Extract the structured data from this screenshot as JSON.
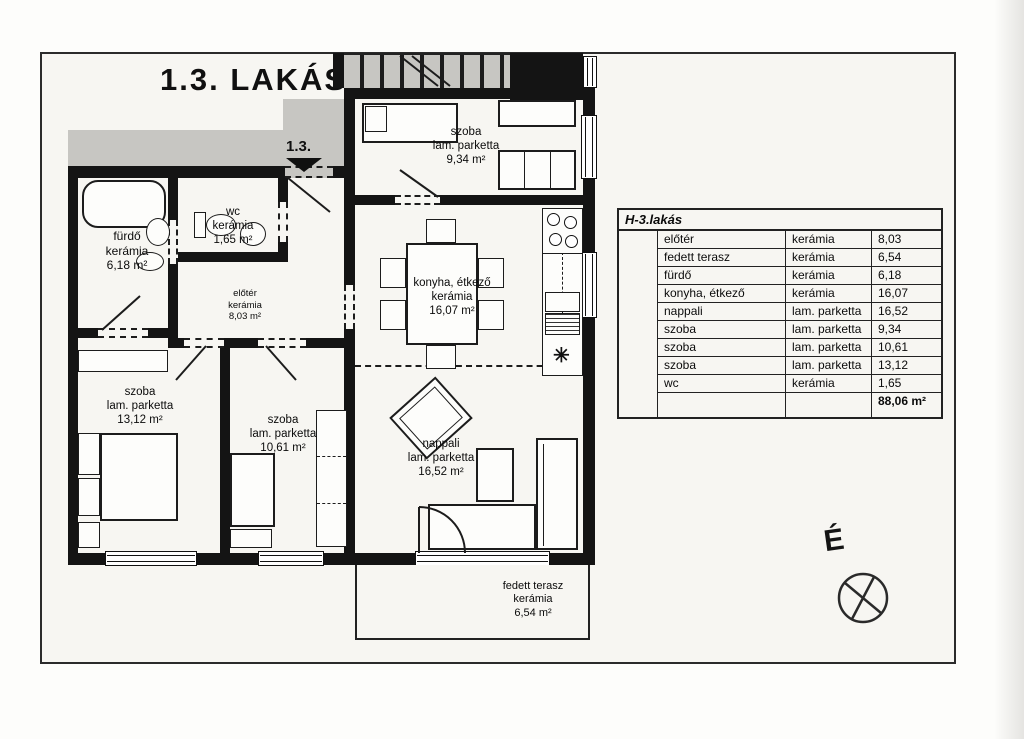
{
  "page": {
    "title": "1.3. LAKÁS",
    "entry_label": "1.3.",
    "compass_label": "É"
  },
  "plan": {
    "rooms": {
      "furdo": {
        "name": "fürdő",
        "material": "kerámia",
        "area": "6,18 m²"
      },
      "wc": {
        "name": "wc",
        "material": "kerámia",
        "area": "1,65 m²"
      },
      "eloter": {
        "name": "előtér",
        "material": "kerámia",
        "area": "8,03 m²"
      },
      "szoba_felso": {
        "name": "szoba",
        "material": "lam. parketta",
        "area": "9,34 m²"
      },
      "konyha": {
        "name": "konyha, étkező",
        "material": "kerámia",
        "area": "16,07 m²"
      },
      "szoba_bal": {
        "name": "szoba",
        "material": "lam. parketta",
        "area": "13,12 m²"
      },
      "szoba_kozep": {
        "name": "szoba",
        "material": "lam. parketta",
        "area": "10,61 m²"
      },
      "nappali": {
        "name": "nappali",
        "material": "lam. parketta",
        "area": "16,52 m²"
      },
      "terasz": {
        "name": "fedett terasz",
        "material": "kerámia",
        "area": "6,54 m²"
      }
    },
    "symbols": {
      "sink_symbol": "✳"
    }
  },
  "table": {
    "title": "H-3.lakás",
    "rows": [
      {
        "name": "előtér",
        "material": "kerámia",
        "area": "8,03"
      },
      {
        "name": "fedett terasz",
        "material": "kerámia",
        "area": "6,54"
      },
      {
        "name": "fürdő",
        "material": "kerámia",
        "area": "6,18"
      },
      {
        "name": "konyha, étkező",
        "material": "kerámia",
        "area": "16,07"
      },
      {
        "name": "nappali",
        "material": "lam. parketta",
        "area": "16,52"
      },
      {
        "name": "szoba",
        "material": "lam. parketta",
        "area": "9,34"
      },
      {
        "name": "szoba",
        "material": "lam. parketta",
        "area": "10,61"
      },
      {
        "name": "szoba",
        "material": "lam. parketta",
        "area": "13,12"
      },
      {
        "name": "wc",
        "material": "kerámia",
        "area": "1,65"
      }
    ],
    "total": "88,06 m²"
  },
  "colors": {
    "wall": "#141414",
    "paper": "#f7f6f2",
    "gray_zone": "#c7c6c2",
    "ink": "#0d0d0d"
  }
}
